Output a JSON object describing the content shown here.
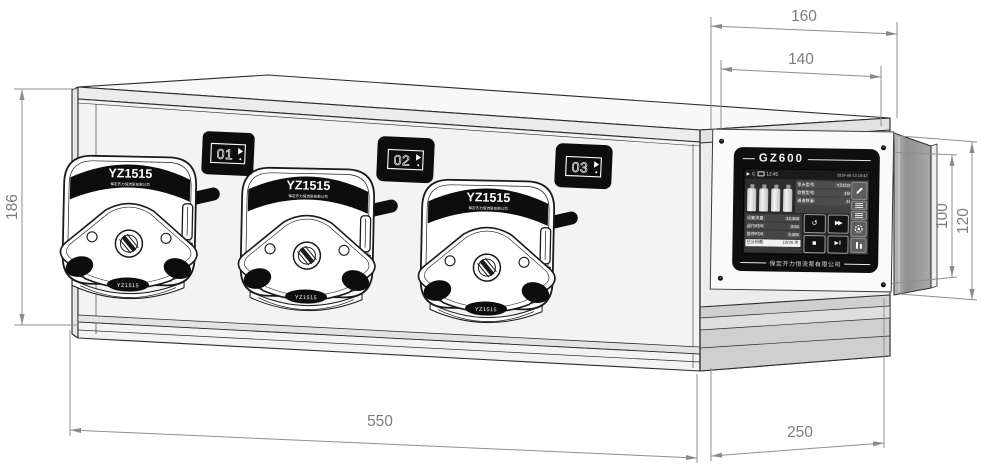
{
  "dimensions": {
    "top_outer": "160",
    "top_inner": "140",
    "left_height": "186",
    "right_inner": "100",
    "right_outer": "120",
    "bottom_front": "550",
    "bottom_side": "250"
  },
  "badges": [
    {
      "number": "01"
    },
    {
      "number": "02"
    },
    {
      "number": "03"
    }
  ],
  "pump": {
    "model": "YZ1515",
    "maker_line": "保定齐力恒流泵有限公司",
    "plate_label": "YZ1515"
  },
  "panel": {
    "title": "GZ600",
    "company": "保定齐力恒流泵有限公司",
    "screen": {
      "status": {
        "play_icon": "▶",
        "refresh_icon": "C",
        "time": "12:45",
        "datetime": "2019-06-13 10:42"
      },
      "info_rows": [
        {
          "label": "泵头型号:",
          "value": "YZ1515"
        },
        {
          "label": "软管型号:",
          "value": "15#"
        },
        {
          "label": "通道数量:",
          "value": "10"
        }
      ],
      "stat_rows": [
        {
          "label": "设置流量:",
          "value": "12.3ml"
        },
        {
          "label": "运行时间:",
          "value": "3.5s"
        },
        {
          "label": "暂停时间:",
          "value": "5.30s"
        },
        {
          "label": "已分份数:",
          "value": "15/20 次"
        }
      ],
      "buttons": {
        "back": "↺",
        "forward": "▶▶",
        "stop": "■",
        "start": "▶‖"
      }
    }
  }
}
